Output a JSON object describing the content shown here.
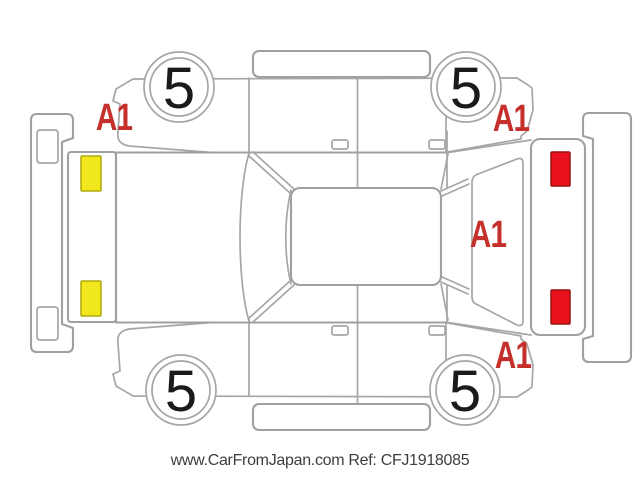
{
  "caption": {
    "site": "www.CarFromJapan.com",
    "ref_label": "Ref:",
    "ref_number": "CFJ1918085",
    "text": "www.CarFromJapan.com Ref: CFJ1918085"
  },
  "diagram": {
    "kind": "vehicle-condition-diagram",
    "tires": [
      {
        "position": "upper-front-wheel",
        "grade": "5"
      },
      {
        "position": "upper-rear-wheel",
        "grade": "5"
      },
      {
        "position": "lower-front-wheel",
        "grade": "5"
      },
      {
        "position": "lower-rear-wheel",
        "grade": "5"
      }
    ],
    "damage_marks": [
      {
        "code": "A1",
        "location": "upper-front-fender"
      },
      {
        "code": "A1",
        "location": "upper-rear-quarter"
      },
      {
        "code": "A1",
        "location": "tailgate"
      },
      {
        "code": "A1",
        "location": "lower-rear-quarter"
      }
    ],
    "colors": {
      "outline": "#a6a6a6",
      "damage_mark": "#c5302c",
      "headlight": "#f0e71d",
      "headlight_border": "#b0a90f",
      "taillight": "#e8111c",
      "taillight_border": "#9a1212",
      "tire_number": "#1b1b1b",
      "caption_text": "#3e3e3e"
    }
  }
}
